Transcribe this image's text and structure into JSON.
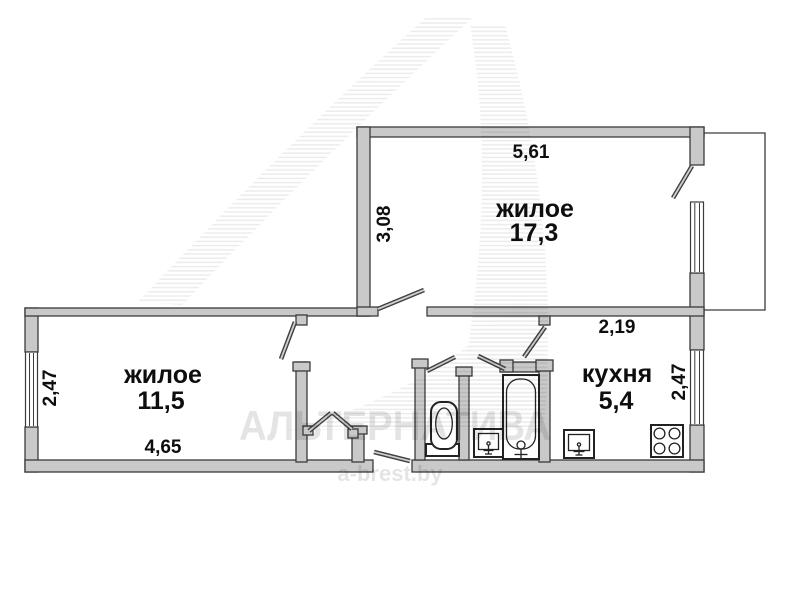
{
  "watermark": {
    "brand": "АЛЬТЕРНАТИВА",
    "site": "a-brest.by"
  },
  "rooms": {
    "living_top": {
      "label": "жилое",
      "area": "17,3",
      "dim_top": "5,61",
      "dim_side": "3,08"
    },
    "living_left": {
      "label": "жилое",
      "area": "11,5",
      "dim_side": "2,47",
      "dim_bottom": "4,65"
    },
    "kitchen": {
      "label": "кухня",
      "area": "5,4",
      "dim_top": "2,19",
      "dim_side": "2,47"
    }
  },
  "fixtures": {
    "toilet": "toilet-icon",
    "bathtub": "bathtub-icon",
    "bath_sink": "sink-icon",
    "kitchen_sink": "sink-icon",
    "stove": "stove-4-burner-icon"
  },
  "colors": {
    "wall_fill": "#c9c9c9",
    "wall_stroke": "#3b3b3b",
    "fixture_stroke": "#222222",
    "label_text": "#0e0e0e",
    "watermark": "#e3e3e3",
    "background": "#ffffff"
  }
}
